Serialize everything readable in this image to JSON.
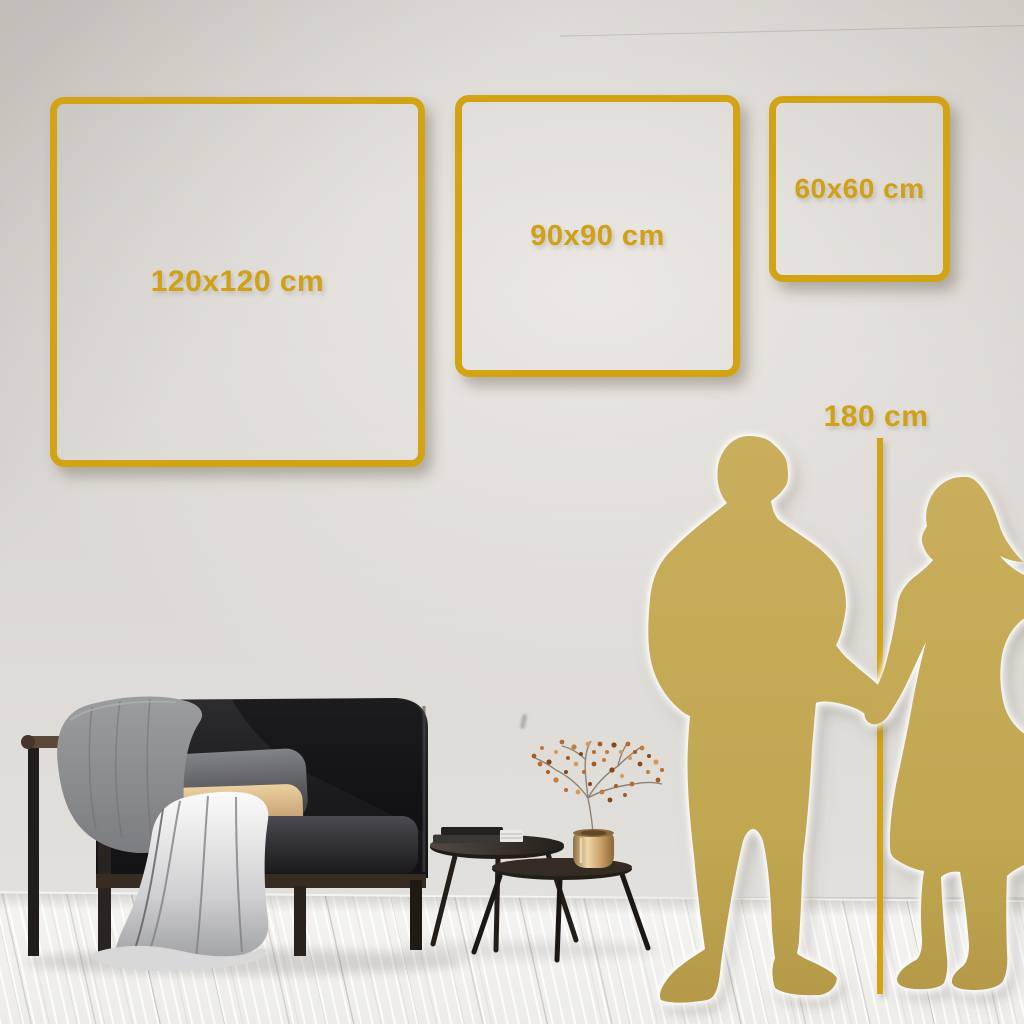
{
  "size_guide": {
    "frames": [
      {
        "id": "120x120",
        "label": "120x120 cm"
      },
      {
        "id": "90x90",
        "label": "90x90 cm"
      },
      {
        "id": "60x60",
        "label": "60x60 cm"
      }
    ],
    "height_reference": {
      "label": "180 cm"
    }
  },
  "colors": {
    "accent_gold": "#D2A315",
    "label_gold": "#D0A016",
    "silhouette_gold": "#C3A955",
    "wall": "#DBD8D3",
    "floor": "#F2F1EF",
    "sofa_dark": "#1B1B1E",
    "pillow_tan": "#D8B488",
    "blanket_gray": "#9A9B9E",
    "wood_dark": "#3A2E24",
    "vase_brass": "#D8BC8A"
  }
}
